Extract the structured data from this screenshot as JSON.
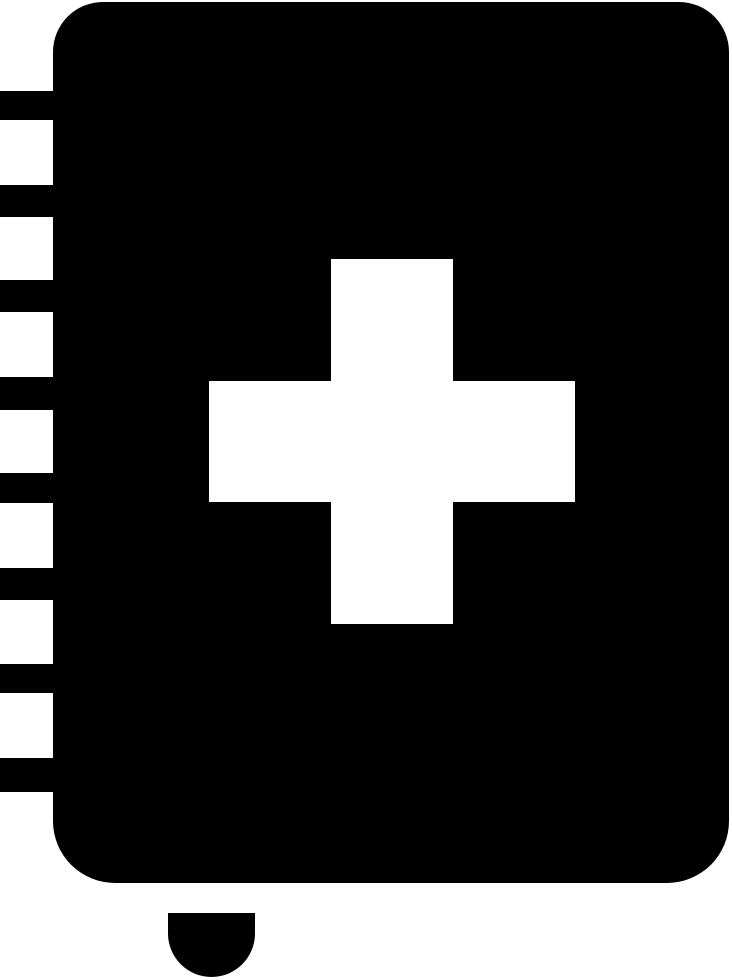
{
  "icon": {
    "name": "first-aid-book-icon",
    "glyph_color": "#000000",
    "background_color": "#ffffff",
    "cross_color": "#ffffff",
    "parts": {
      "cover_label": "book-cover",
      "cross_label": "medical-cross",
      "binding_label": "spiral-binding-tabs",
      "charm_label": "bottom-charm",
      "binding_tab_count": 8
    }
  }
}
